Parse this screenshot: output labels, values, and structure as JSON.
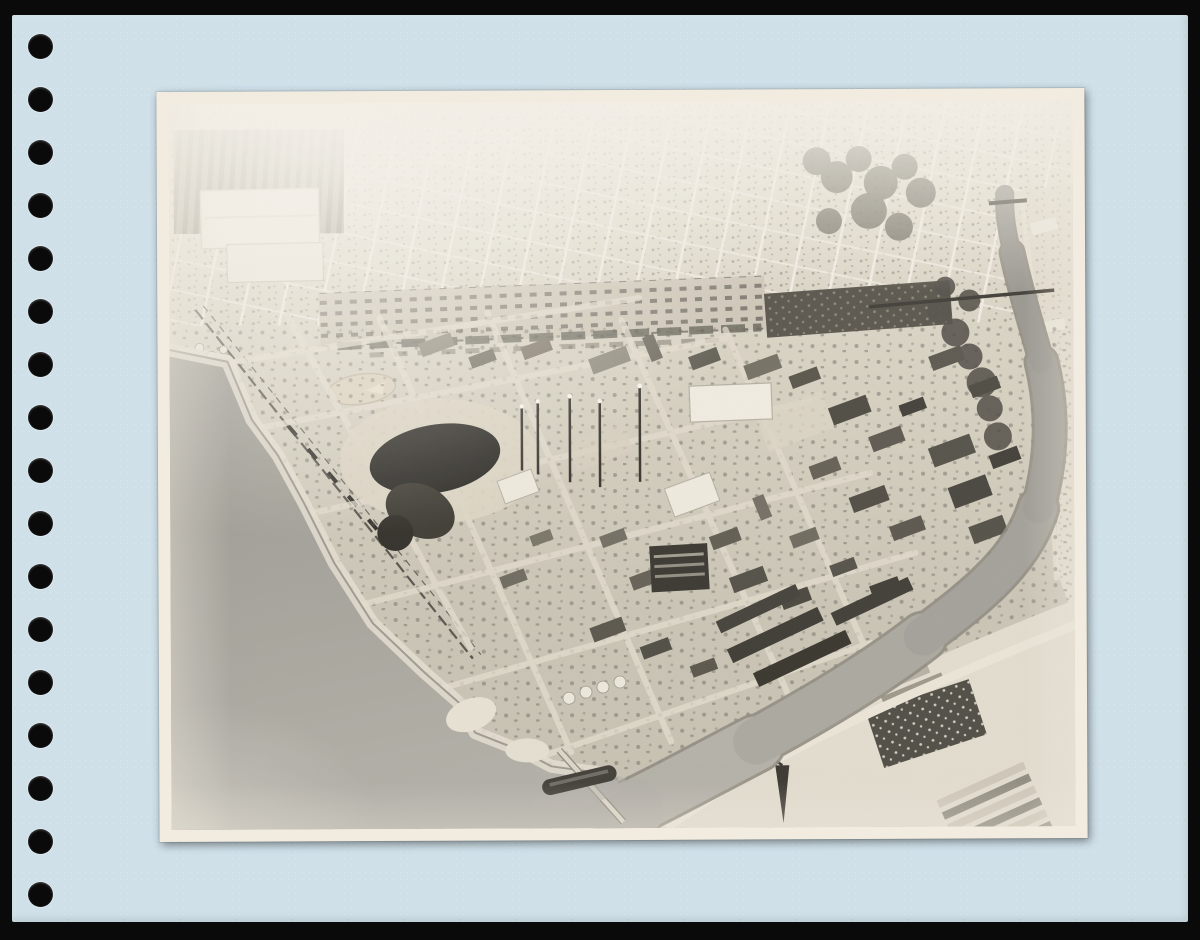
{
  "artifact": {
    "type": "scanned photo album page with mounted aerial photograph",
    "background_color": "#0a0a0a",
    "page_color": "#cfe0e9",
    "mat_color": "#f1ecdf",
    "hole_color": "#0a0a0a"
  },
  "binder": {
    "hole_count": 17
  },
  "photo": {
    "description": "Black-and-white oblique aerial photograph of an industrial waterfront peninsula: harbor water on the left, a curving tidal channel on the right crossed by trestle bridges, a dark circular gas holder and dense refinery buildings with smokestacks in the center, warehouse rows and storage tanks toward the point, a ship moored at a wharf near the bottom, greenhouse rows and a skylight-roofed building across the channel, an orchard and large warehouse roofs at upper left, and a sunlit residential street grid fading out toward the top.",
    "palette": {
      "highlight": "#f4f1e9",
      "light": "#ddd8cb",
      "mid": "#b3afa5",
      "water": "#a7a59e",
      "dark": "#55534b",
      "darkest": "#23221f"
    },
    "features": [
      "residential-street-grid",
      "orchard-rows",
      "warehouse-roofs",
      "parking-lots",
      "baseball-field",
      "rail-line",
      "harbor-water",
      "rocky-shoreline",
      "gas-holder",
      "refinery-buildings",
      "smokestacks",
      "warehouse-rows",
      "storage-tanks",
      "ship-at-wharf",
      "pier",
      "tidal-channel",
      "rail-trestle-bridge",
      "road-bridge",
      "greenhouse-rows",
      "skylight-roof-building",
      "crane-tower"
    ]
  }
}
